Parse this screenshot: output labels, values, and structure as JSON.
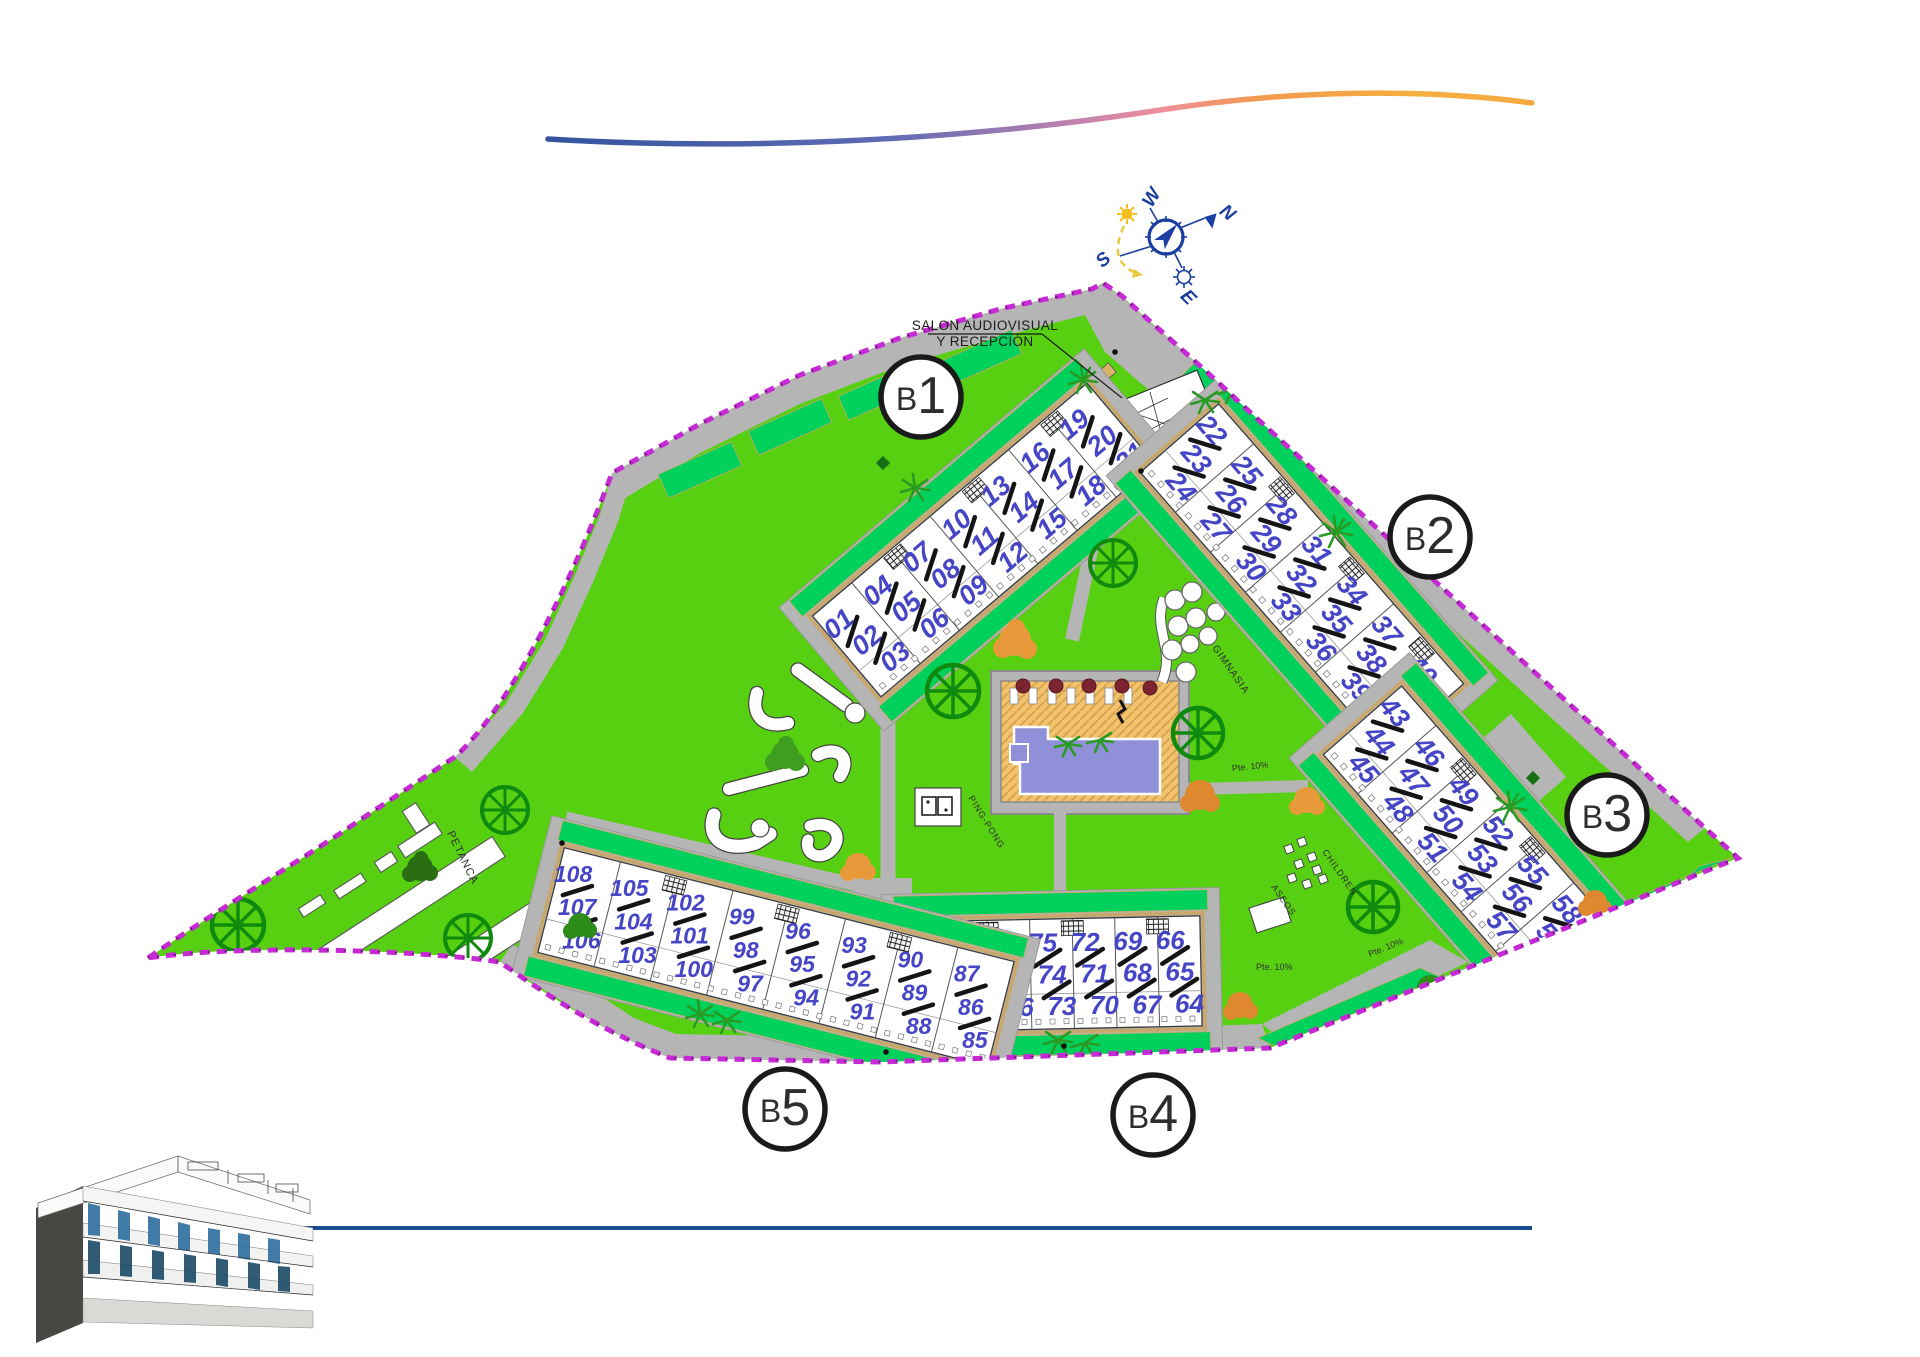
{
  "site": {
    "compass": {
      "n": "N",
      "s": "S",
      "e": "E",
      "w": "W"
    },
    "labels": {
      "reception_line1": "SALON AUDIOVISUAL",
      "reception_line2": "Y RECEPCIÓN",
      "petanca": "PETANCA",
      "gimnasia": "GIMNASIA",
      "pingpong": "PING-PONG",
      "children": "CHILDREN",
      "aseos": "ASEOS",
      "ramp": "Pte. 10%"
    },
    "blocks": [
      {
        "id": "b1",
        "label": "B1",
        "columns": [
          [
            "01",
            "02",
            "03"
          ],
          [
            "04",
            "05",
            "06"
          ],
          [
            "07",
            "08",
            "09"
          ],
          [
            "10",
            "11",
            "12"
          ],
          [
            "13",
            "14",
            "15"
          ],
          [
            "16",
            "17",
            "18"
          ],
          [
            "19",
            "20",
            "21"
          ]
        ]
      },
      {
        "id": "b2",
        "label": "B2",
        "columns": [
          [
            "22",
            "23",
            "24"
          ],
          [
            "25",
            "26",
            "27"
          ],
          [
            "28",
            "29",
            "30"
          ],
          [
            "31",
            "32",
            "33"
          ],
          [
            "34",
            "35",
            "36"
          ],
          [
            "37",
            "38",
            "39"
          ],
          [
            "40",
            "41",
            "42"
          ]
        ]
      },
      {
        "id": "b3",
        "label": "B3",
        "columns": [
          [
            "43",
            "44",
            "45"
          ],
          [
            "46",
            "47",
            "48"
          ],
          [
            "49",
            "50",
            "51"
          ],
          [
            "52",
            "53",
            "54"
          ],
          [
            "55",
            "56",
            "57"
          ],
          [
            "58",
            "59",
            "60"
          ],
          [
            "61",
            "62",
            "63"
          ]
        ]
      },
      {
        "id": "b4",
        "label": "B4",
        "columns": [
          [
            "84",
            "83",
            "82"
          ],
          [
            "81",
            "80",
            "79"
          ],
          [
            "78",
            "77",
            "76"
          ],
          [
            "75",
            "74",
            "73"
          ],
          [
            "72",
            "71",
            "70"
          ],
          [
            "69",
            "68",
            "67"
          ],
          [
            "66",
            "65",
            "64"
          ]
        ]
      },
      {
        "id": "b5",
        "label": "B5",
        "columns": [
          [
            "108",
            "107",
            "106"
          ],
          [
            "105",
            "104",
            "103"
          ],
          [
            "102",
            "101",
            "100"
          ],
          [
            "99",
            "98",
            "97"
          ],
          [
            "96",
            "95",
            "94"
          ],
          [
            "93",
            "92",
            "91"
          ],
          [
            "90",
            "89",
            "88"
          ],
          [
            "87",
            "86",
            "85"
          ]
        ]
      }
    ],
    "colors": {
      "lawn": "#57d011",
      "hedge": "#00d05c",
      "road": "#b5b5b5",
      "water": "#8f90d8",
      "deck": "#f2c36c",
      "boundary": "#c62ad4",
      "unit_number": "#4545c6",
      "compass_blue": "#1b3fa0",
      "bottom_line": "#1b4d90"
    }
  }
}
